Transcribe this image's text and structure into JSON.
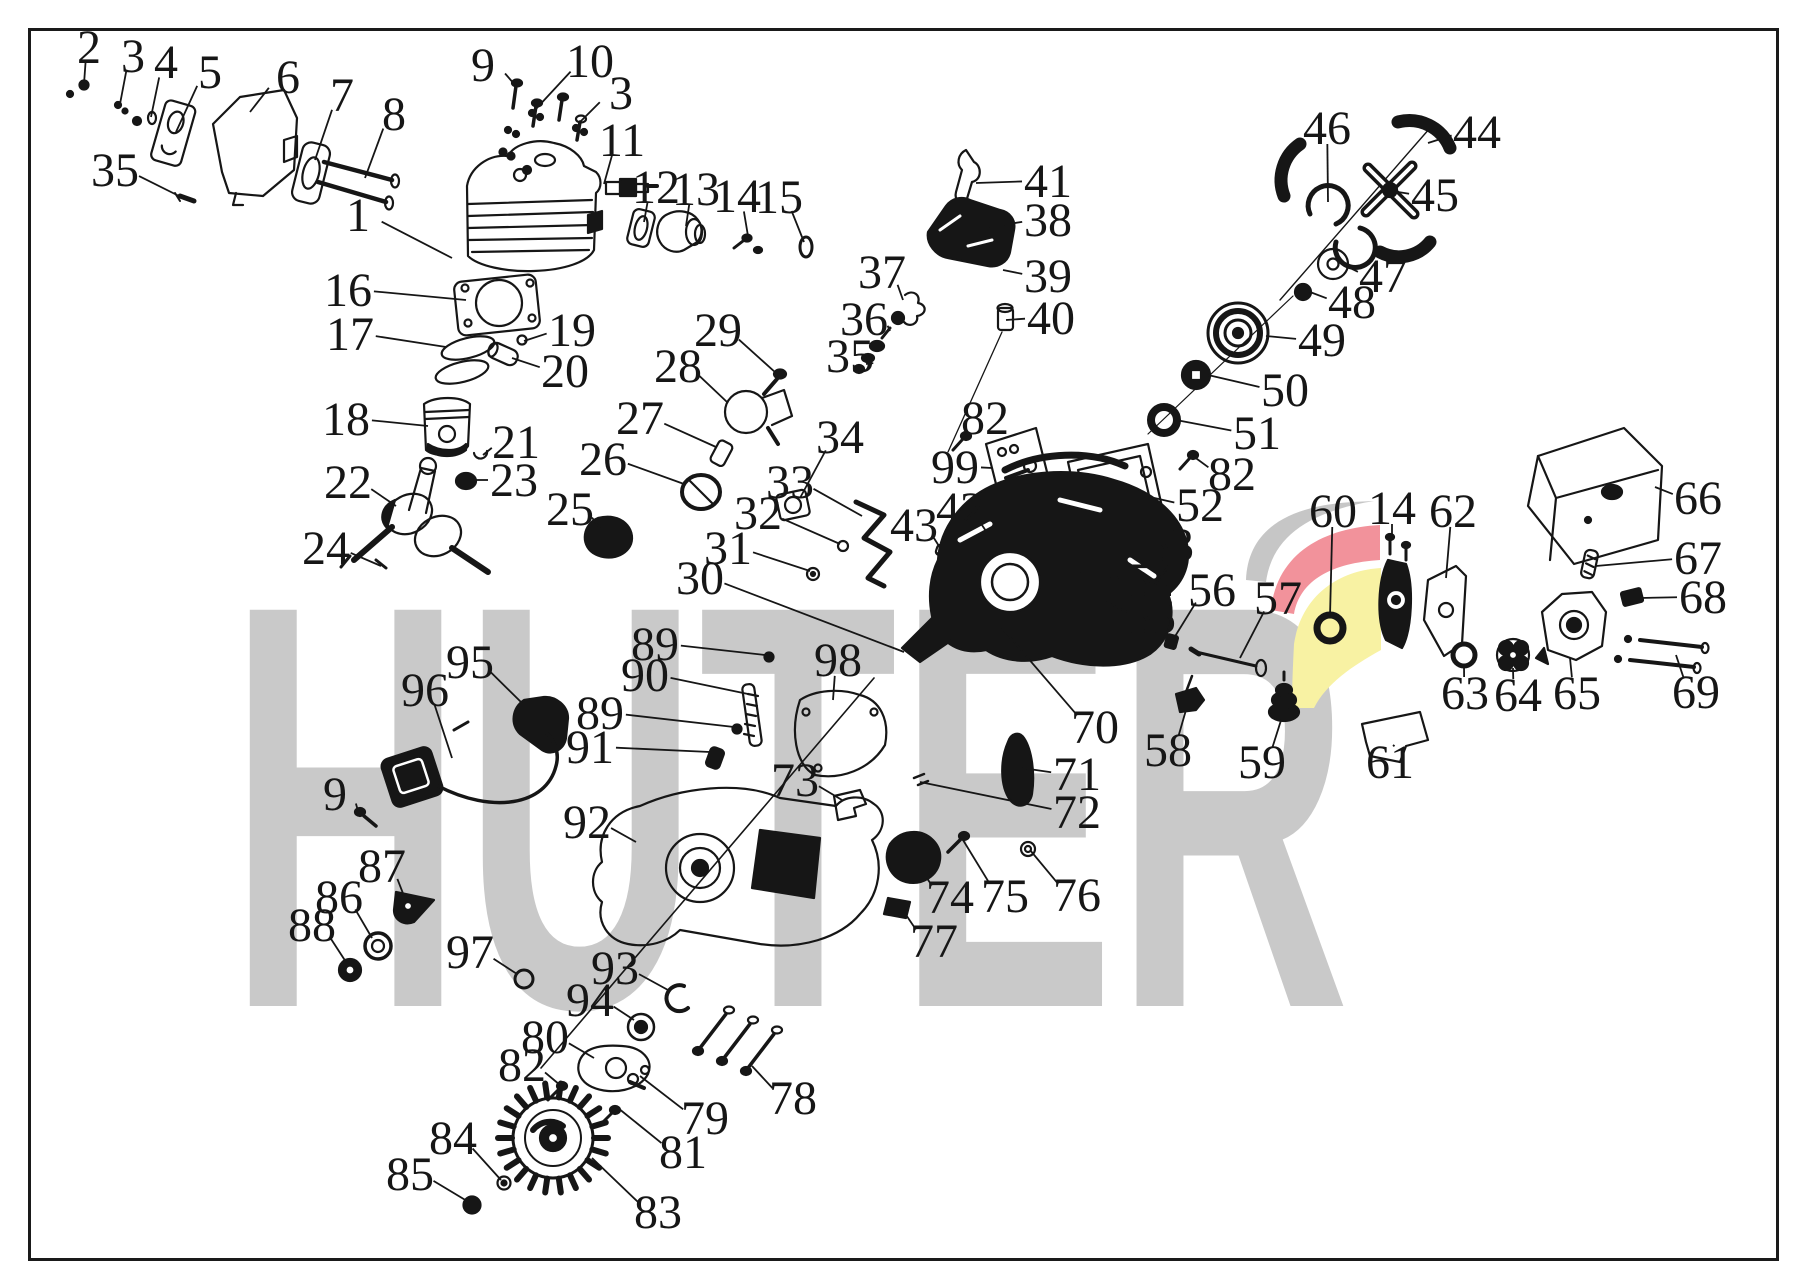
{
  "watermark": {
    "text": "HUTER",
    "color": "#c9c9c9"
  },
  "logo": {
    "gray": "#c6c6c6",
    "red": "#f2929b",
    "yellow": "#f8f2a3"
  },
  "diagram": {
    "ink": "#161616",
    "background": "#ffffff",
    "border_color": "#1a1a1a"
  },
  "labels": [
    {
      "n": "2",
      "x": 89,
      "y": 47,
      "ex": 84,
      "ey": 84
    },
    {
      "n": "3",
      "x": 133,
      "y": 56,
      "ex": 120,
      "ey": 104
    },
    {
      "n": "4",
      "x": 166,
      "y": 62,
      "ex": 151,
      "ey": 117
    },
    {
      "n": "5",
      "x": 210,
      "y": 72,
      "ex": 176,
      "ey": 132
    },
    {
      "n": "6",
      "x": 288,
      "y": 77,
      "ex": 250,
      "ey": 112
    },
    {
      "n": "7",
      "x": 342,
      "y": 95,
      "ex": 315,
      "ey": 160
    },
    {
      "n": "8",
      "x": 394,
      "y": 114,
      "ex": 365,
      "ey": 178
    },
    {
      "n": "35",
      "x": 115,
      "y": 170,
      "ex": 183,
      "ey": 198
    },
    {
      "n": "9",
      "x": 483,
      "y": 65,
      "ex": 515,
      "ey": 85
    },
    {
      "n": "10",
      "x": 590,
      "y": 61,
      "ex": 535,
      "ey": 110
    },
    {
      "n": "3",
      "x": 621,
      "y": 93,
      "ex": 580,
      "ey": 122
    },
    {
      "n": "11",
      "x": 622,
      "y": 140,
      "ex": 604,
      "ey": 184
    },
    {
      "n": "12",
      "x": 656,
      "y": 187,
      "ex": 644,
      "ey": 222
    },
    {
      "n": "13",
      "x": 696,
      "y": 189,
      "ex": 686,
      "ey": 226
    },
    {
      "n": "14",
      "x": 737,
      "y": 196,
      "ex": 748,
      "ey": 236
    },
    {
      "n": "15",
      "x": 779,
      "y": 197,
      "ex": 804,
      "ey": 242
    },
    {
      "n": "1",
      "x": 358,
      "y": 215,
      "ex": 452,
      "ey": 258
    },
    {
      "n": "16",
      "x": 348,
      "y": 290,
      "ex": 466,
      "ey": 300
    },
    {
      "n": "17",
      "x": 350,
      "y": 334,
      "ex": 446,
      "ey": 347
    },
    {
      "n": "19",
      "x": 572,
      "y": 330,
      "ex": 524,
      "ey": 341
    },
    {
      "n": "20",
      "x": 565,
      "y": 371,
      "ex": 512,
      "ey": 358
    },
    {
      "n": "18",
      "x": 346,
      "y": 419,
      "ex": 428,
      "ey": 426
    },
    {
      "n": "21",
      "x": 516,
      "y": 442,
      "ex": 483,
      "ey": 455
    },
    {
      "n": "23",
      "x": 514,
      "y": 480,
      "ex": 472,
      "ey": 480
    },
    {
      "n": "22",
      "x": 348,
      "y": 482,
      "ex": 396,
      "ey": 506
    },
    {
      "n": "24",
      "x": 326,
      "y": 548,
      "ex": 381,
      "ey": 566
    },
    {
      "n": "25",
      "x": 570,
      "y": 509,
      "ex": 600,
      "ey": 528
    },
    {
      "n": "26",
      "x": 603,
      "y": 459,
      "ex": 684,
      "ey": 484
    },
    {
      "n": "27",
      "x": 640,
      "y": 418,
      "ex": 716,
      "ey": 447
    },
    {
      "n": "28",
      "x": 678,
      "y": 366,
      "ex": 727,
      "ey": 402
    },
    {
      "n": "29",
      "x": 718,
      "y": 330,
      "ex": 776,
      "ey": 373
    },
    {
      "n": "30",
      "x": 700,
      "y": 578,
      "ex": 904,
      "ey": 652
    },
    {
      "n": "31",
      "x": 728,
      "y": 548,
      "ex": 810,
      "ey": 571
    },
    {
      "n": "32",
      "x": 758,
      "y": 513,
      "ex": 840,
      "ey": 544
    },
    {
      "n": "33",
      "x": 790,
      "y": 482,
      "ex": 862,
      "ey": 516
    },
    {
      "n": "34",
      "x": 840,
      "y": 437,
      "ex": 800,
      "ey": 498
    },
    {
      "n": "37",
      "x": 882,
      "y": 272,
      "ex": 903,
      "ey": 300
    },
    {
      "n": "36",
      "x": 864,
      "y": 319,
      "ex": 890,
      "ey": 331
    },
    {
      "n": "35",
      "x": 850,
      "y": 356,
      "ex": 866,
      "ey": 364
    },
    {
      "n": "41",
      "x": 1048,
      "y": 181,
      "ex": 976,
      "ey": 183
    },
    {
      "n": "38",
      "x": 1048,
      "y": 220,
      "ex": 989,
      "ey": 227
    },
    {
      "n": "39",
      "x": 1048,
      "y": 276,
      "ex": 1003,
      "ey": 270
    },
    {
      "n": "40",
      "x": 1051,
      "y": 318,
      "ex": 1006,
      "ey": 320
    },
    {
      "n": "82",
      "x": 985,
      "y": 418,
      "ex": 964,
      "ey": 437
    },
    {
      "n": "99",
      "x": 955,
      "y": 467,
      "ex": 992,
      "ey": 468
    },
    {
      "n": "43",
      "x": 914,
      "y": 525,
      "ex": 944,
      "ey": 554
    },
    {
      "n": "42",
      "x": 960,
      "y": 509,
      "ex": 992,
      "ey": 540
    },
    {
      "n": "52",
      "x": 1200,
      "y": 505,
      "ex": 1150,
      "ey": 497
    },
    {
      "n": "82",
      "x": 1232,
      "y": 474,
      "ex": 1193,
      "ey": 456
    },
    {
      "n": "53",
      "x": 1170,
      "y": 545,
      "ex": 1100,
      "ey": 545
    },
    {
      "n": "54",
      "x": 1152,
      "y": 580,
      "ex": 1080,
      "ey": 573
    },
    {
      "n": "55",
      "x": 1152,
      "y": 617,
      "ex": 1106,
      "ey": 602
    },
    {
      "n": "56",
      "x": 1212,
      "y": 590,
      "ex": 1174,
      "ey": 638
    },
    {
      "n": "57",
      "x": 1278,
      "y": 598,
      "ex": 1240,
      "ey": 658
    },
    {
      "n": "58",
      "x": 1168,
      "y": 750,
      "ex": 1186,
      "ey": 710
    },
    {
      "n": "59",
      "x": 1262,
      "y": 762,
      "ex": 1283,
      "ey": 714
    },
    {
      "n": "60",
      "x": 1333,
      "y": 511,
      "ex": 1330,
      "ey": 616
    },
    {
      "n": "61",
      "x": 1390,
      "y": 762,
      "ex": 1393,
      "ey": 745
    },
    {
      "n": "14",
      "x": 1392,
      "y": 508,
      "ex": 1392,
      "ey": 540
    },
    {
      "n": "62",
      "x": 1453,
      "y": 511,
      "ex": 1446,
      "ey": 578
    },
    {
      "n": "63",
      "x": 1465,
      "y": 693,
      "ex": 1464,
      "ey": 664
    },
    {
      "n": "64",
      "x": 1518,
      "y": 695,
      "ex": 1513,
      "ey": 668
    },
    {
      "n": "65",
      "x": 1577,
      "y": 693,
      "ex": 1570,
      "ey": 658
    },
    {
      "n": "66",
      "x": 1698,
      "y": 498,
      "ex": 1655,
      "ey": 487
    },
    {
      "n": "67",
      "x": 1698,
      "y": 558,
      "ex": 1596,
      "ey": 566
    },
    {
      "n": "68",
      "x": 1703,
      "y": 597,
      "ex": 1640,
      "ey": 598
    },
    {
      "n": "69",
      "x": 1696,
      "y": 692,
      "ex": 1676,
      "ey": 655
    },
    {
      "n": "44",
      "x": 1477,
      "y": 132,
      "ex": 1428,
      "ey": 143
    },
    {
      "n": "45",
      "x": 1435,
      "y": 195,
      "ex": 1398,
      "ey": 192
    },
    {
      "n": "46",
      "x": 1327,
      "y": 128,
      "ex": 1328,
      "ey": 202
    },
    {
      "n": "47",
      "x": 1383,
      "y": 276,
      "ex": 1346,
      "ey": 266
    },
    {
      "n": "48",
      "x": 1352,
      "y": 302,
      "ex": 1310,
      "ey": 292
    },
    {
      "n": "49",
      "x": 1322,
      "y": 340,
      "ex": 1266,
      "ey": 336
    },
    {
      "n": "50",
      "x": 1285,
      "y": 390,
      "ex": 1208,
      "ey": 375
    },
    {
      "n": "51",
      "x": 1257,
      "y": 433,
      "ex": 1176,
      "ey": 420
    },
    {
      "n": "70",
      "x": 1095,
      "y": 727,
      "ex": 1002,
      "ey": 628
    },
    {
      "n": "71",
      "x": 1077,
      "y": 774,
      "ex": 1022,
      "ey": 768
    },
    {
      "n": "72",
      "x": 1077,
      "y": 812,
      "ex": 920,
      "ey": 782
    },
    {
      "n": "73",
      "x": 795,
      "y": 780,
      "ex": 842,
      "ey": 800
    },
    {
      "n": "74",
      "x": 950,
      "y": 897,
      "ex": 916,
      "ey": 862
    },
    {
      "n": "75",
      "x": 1005,
      "y": 896,
      "ex": 963,
      "ey": 840
    },
    {
      "n": "76",
      "x": 1077,
      "y": 895,
      "ex": 1030,
      "ey": 850
    },
    {
      "n": "77",
      "x": 934,
      "y": 941,
      "ex": 900,
      "ey": 906
    },
    {
      "n": "89",
      "x": 655,
      "y": 644,
      "ex": 765,
      "ey": 655
    },
    {
      "n": "90",
      "x": 645,
      "y": 675,
      "ex": 748,
      "ey": 694
    },
    {
      "n": "89",
      "x": 600,
      "y": 713,
      "ex": 734,
      "ey": 727
    },
    {
      "n": "91",
      "x": 590,
      "y": 747,
      "ex": 710,
      "ey": 752
    },
    {
      "n": "98",
      "x": 838,
      "y": 660,
      "ex": 833,
      "ey": 700
    },
    {
      "n": "95",
      "x": 470,
      "y": 662,
      "ex": 522,
      "ey": 703
    },
    {
      "n": "96",
      "x": 425,
      "y": 690,
      "ex": 452,
      "ey": 758
    },
    {
      "n": "9",
      "x": 335,
      "y": 794,
      "ex": 358,
      "ey": 811
    },
    {
      "n": "87",
      "x": 382,
      "y": 866,
      "ex": 404,
      "ey": 896
    },
    {
      "n": "86",
      "x": 339,
      "y": 897,
      "ex": 372,
      "ey": 938
    },
    {
      "n": "88",
      "x": 312,
      "y": 925,
      "ex": 346,
      "ey": 962
    },
    {
      "n": "92",
      "x": 587,
      "y": 822,
      "ex": 636,
      "ey": 842
    },
    {
      "n": "97",
      "x": 470,
      "y": 952,
      "ex": 517,
      "ey": 974
    },
    {
      "n": "93",
      "x": 615,
      "y": 968,
      "ex": 668,
      "ey": 990
    },
    {
      "n": "94",
      "x": 590,
      "y": 1000,
      "ex": 634,
      "ey": 1020
    },
    {
      "n": "80",
      "x": 545,
      "y": 1037,
      "ex": 594,
      "ey": 1058
    },
    {
      "n": "82",
      "x": 522,
      "y": 1065,
      "ex": 560,
      "ey": 1085
    },
    {
      "n": "79",
      "x": 705,
      "y": 1118,
      "ex": 640,
      "ey": 1076
    },
    {
      "n": "81",
      "x": 683,
      "y": 1152,
      "ex": 618,
      "ey": 1108
    },
    {
      "n": "78",
      "x": 793,
      "y": 1098,
      "ex": 752,
      "ey": 1066
    },
    {
      "n": "84",
      "x": 453,
      "y": 1138,
      "ex": 501,
      "ey": 1180
    },
    {
      "n": "85",
      "x": 410,
      "y": 1174,
      "ex": 467,
      "ey": 1201
    },
    {
      "n": "83",
      "x": 658,
      "y": 1212,
      "ex": 592,
      "ey": 1158
    }
  ]
}
